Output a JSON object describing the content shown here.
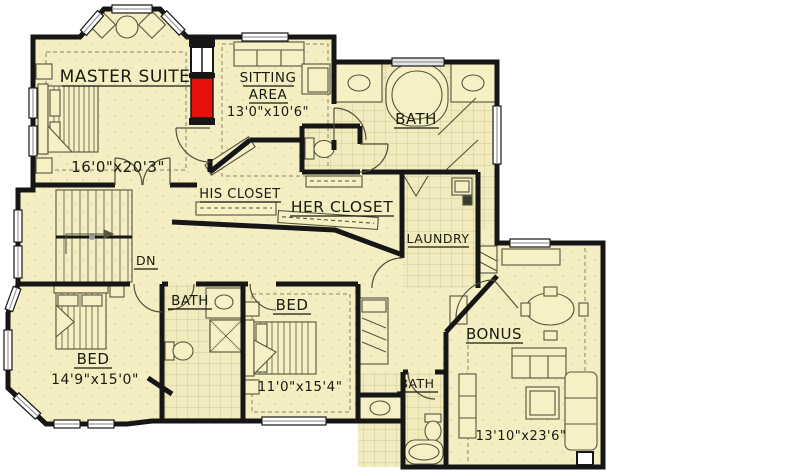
{
  "plan_title": "Upper floor plan",
  "colors": {
    "floor": "#f4eec2",
    "wall": "#161616",
    "fireplace_red": "#e8100c",
    "tile_line": "#cbc08a",
    "window_white": "#ffffff",
    "sill_gray": "#9a9a9a"
  },
  "rooms": {
    "master": {
      "name": "MASTER SUITE",
      "dims": "16'0\"x20'3\""
    },
    "sitting": {
      "name_line1": "SITTING",
      "name_line2": "AREA",
      "dims": "13'0\"x10'6\""
    },
    "master_bath": {
      "name": "BATH"
    },
    "his_closet": {
      "name": "HIS CLOSET"
    },
    "her_closet": {
      "name": "HER CLOSET"
    },
    "laundry": {
      "name": "LAUNDRY"
    },
    "stairs": {
      "name": "DN"
    },
    "hall_bath": {
      "name": "BATH"
    },
    "bedroom_left": {
      "name": "BED",
      "dims": "14'9\"x15'0\""
    },
    "bedroom_mid": {
      "name": "BED",
      "dims": "11'0\"x15'4\""
    },
    "lower_bath": {
      "name": "BATH"
    },
    "bonus": {
      "name": "BONUS",
      "dims": "13'10\"x23'6\""
    }
  }
}
